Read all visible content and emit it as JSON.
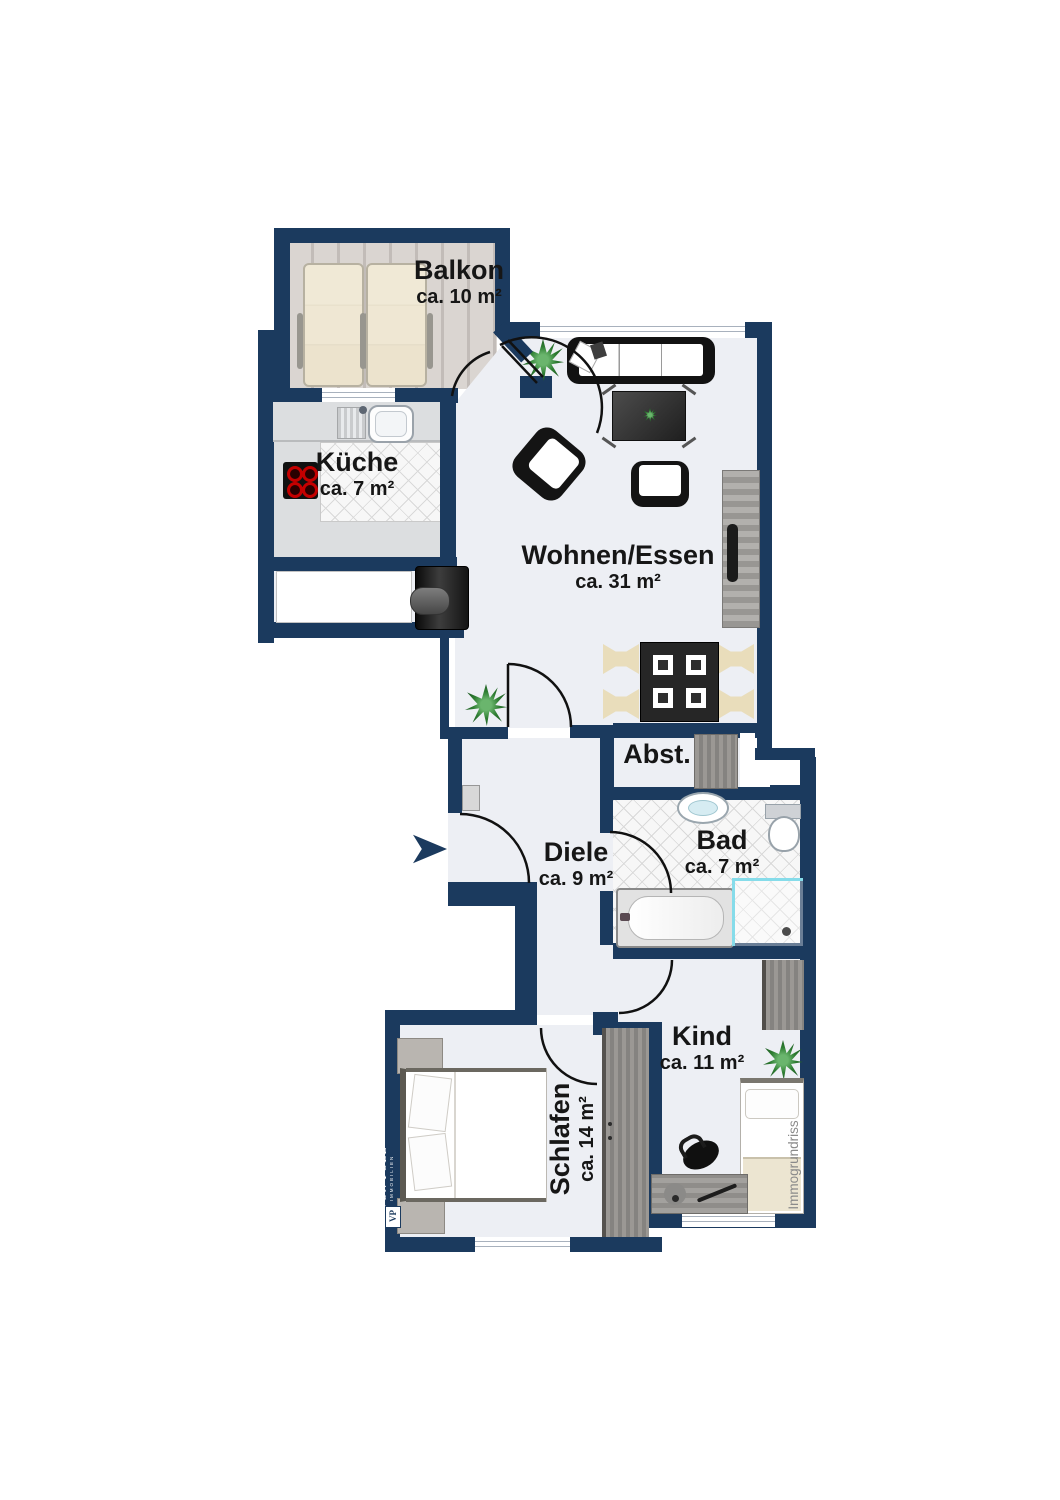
{
  "rooms": {
    "balkon": {
      "name": "Balkon",
      "area": "ca. 10 m²"
    },
    "kueche": {
      "name": "Küche",
      "area": "ca. 7 m²"
    },
    "wohnen": {
      "name": "Wohnen/Essen",
      "area": "ca. 31 m²"
    },
    "abstell": {
      "name": "Abst."
    },
    "diele": {
      "name": "Diele",
      "area": "ca. 9 m²"
    },
    "bad": {
      "name": "Bad",
      "area": "ca. 7 m²"
    },
    "kind": {
      "name": "Kind",
      "area": "ca. 11 m²"
    },
    "schlafen": {
      "name": "Schlafen",
      "area": "ca. 14 m²"
    }
  },
  "branding": {
    "company": "VON POLL",
    "company_sub": "IMMOBILIEN",
    "logo_monogram": "VP",
    "watermark": "Immogrundriss"
  },
  "colors": {
    "wall": "#1b3a5e",
    "floor": "#edeff4",
    "tile": "#f7f7f7",
    "balcony_wood": "#d5d0cc",
    "shower_glass": "#86dcea",
    "plant": "#2e7d32",
    "label_text": "#161616",
    "watermark_text": "#8a8a8a"
  }
}
